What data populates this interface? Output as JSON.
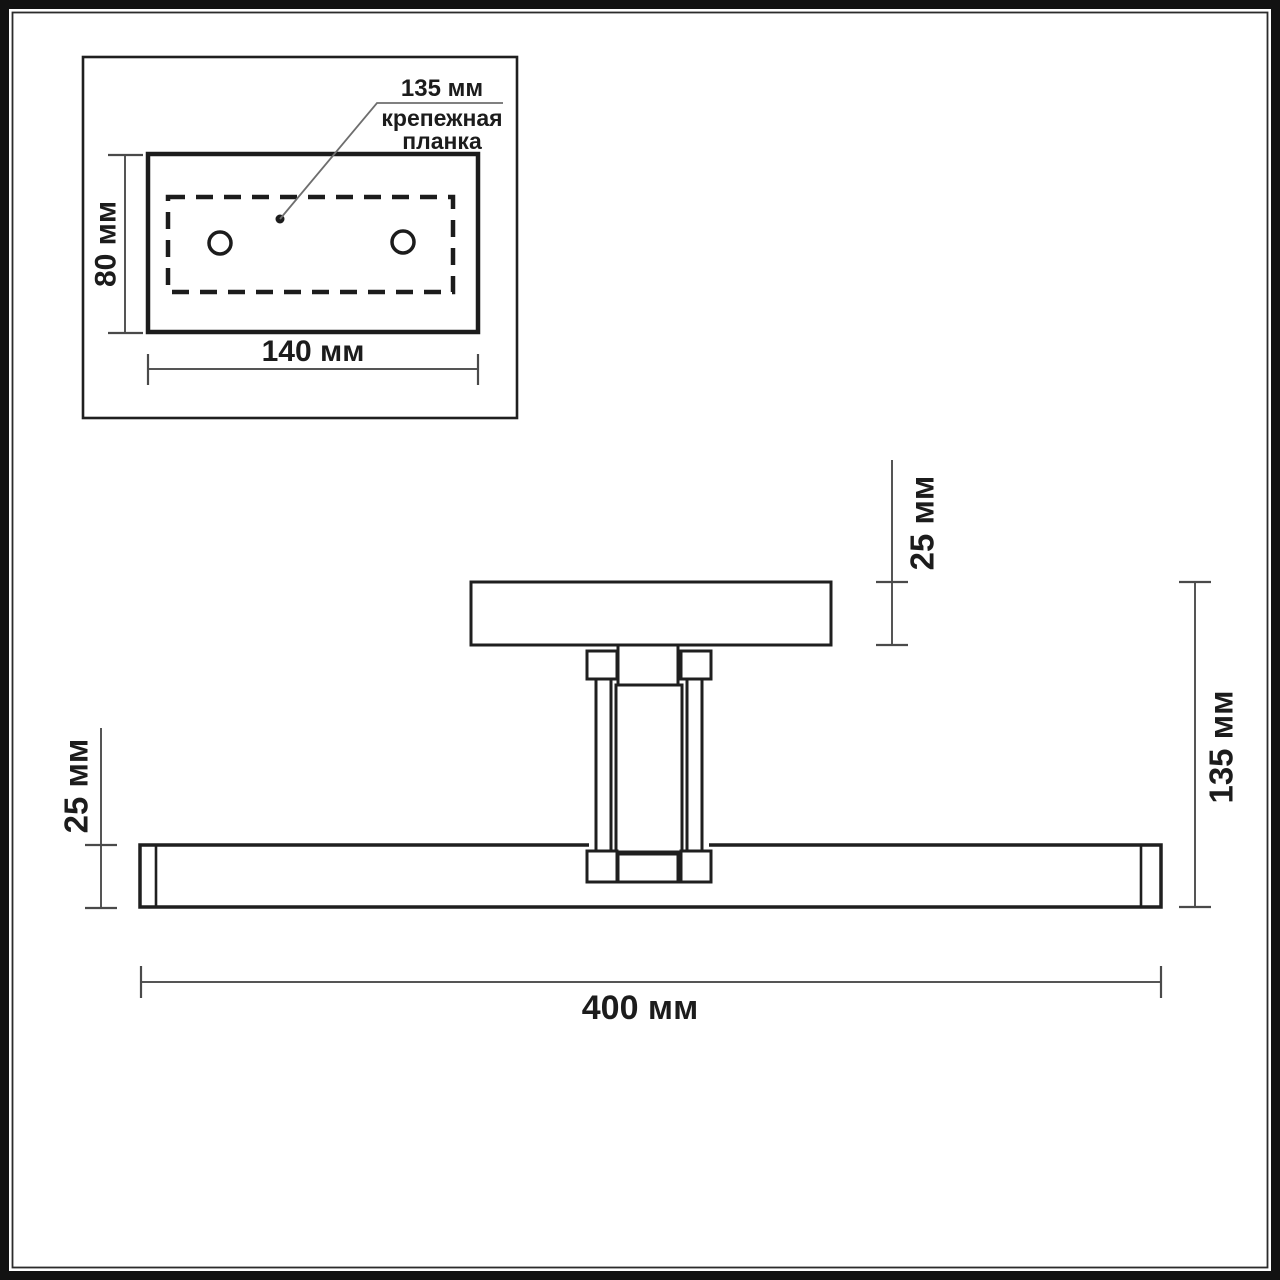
{
  "inset": {
    "hole_spacing_label": "135 мм",
    "caption": [
      "крепежная",
      "планка"
    ],
    "height_label": "80 мм",
    "width_label": "140 мм"
  },
  "side_view": {
    "canopy_thickness_label": "25 мм",
    "fixture_height_label": "135 мм",
    "bar_thickness_label": "25 мм",
    "bar_length_label": "400 мм"
  },
  "colors": {
    "line": "#1f1f1f",
    "dimension": "#555555",
    "leader": "#6e6e6e",
    "frame": "#121212",
    "background": "#ffffff"
  }
}
